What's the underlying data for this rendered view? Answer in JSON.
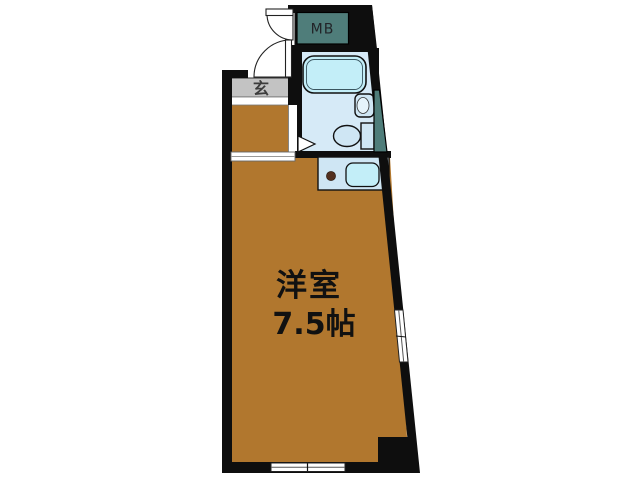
{
  "floorplan": {
    "kind": "japanese-apartment-floor-plan",
    "labels": {
      "main_room_name": "洋室",
      "main_room_size": "7.5帖",
      "entrance": "玄",
      "meter_box": "MB"
    },
    "rooms": [
      {
        "name": "洋室",
        "size_text": "7.5帖",
        "type": "western-style-room"
      },
      {
        "name": "玄",
        "type": "entrance-genkan"
      },
      {
        "name": "MB",
        "type": "meter-box"
      },
      {
        "name": "",
        "type": "unit-bath",
        "fixtures": [
          "bathtub",
          "washbasin",
          "toilet"
        ]
      },
      {
        "name": "",
        "type": "kitchenette",
        "fixtures": [
          "single-burner",
          "kitchen-sink"
        ]
      },
      {
        "name": "",
        "type": "pipe-space"
      }
    ],
    "openings": {
      "entry_doors": 2,
      "bath_door_marker": "triangle",
      "windows": [
        "bottom-wall-window",
        "right-wall-window"
      ],
      "hall_opening": "sliding-opening-between-hall-and-room"
    },
    "colors": {
      "room_floor": "#b1772e",
      "genkan_floor": "#c3c3c3",
      "bath_floor": "#d6eaf7",
      "counter_blue": "#cfe6f4",
      "fixture_cyan": "#c3eef8",
      "fixture_inner": "#e6f4fb",
      "meter_box_teal": "#4f7d7a",
      "burner_dot": "#53301f",
      "wall": "#0e0e0e",
      "background": "#ffffff"
    }
  }
}
